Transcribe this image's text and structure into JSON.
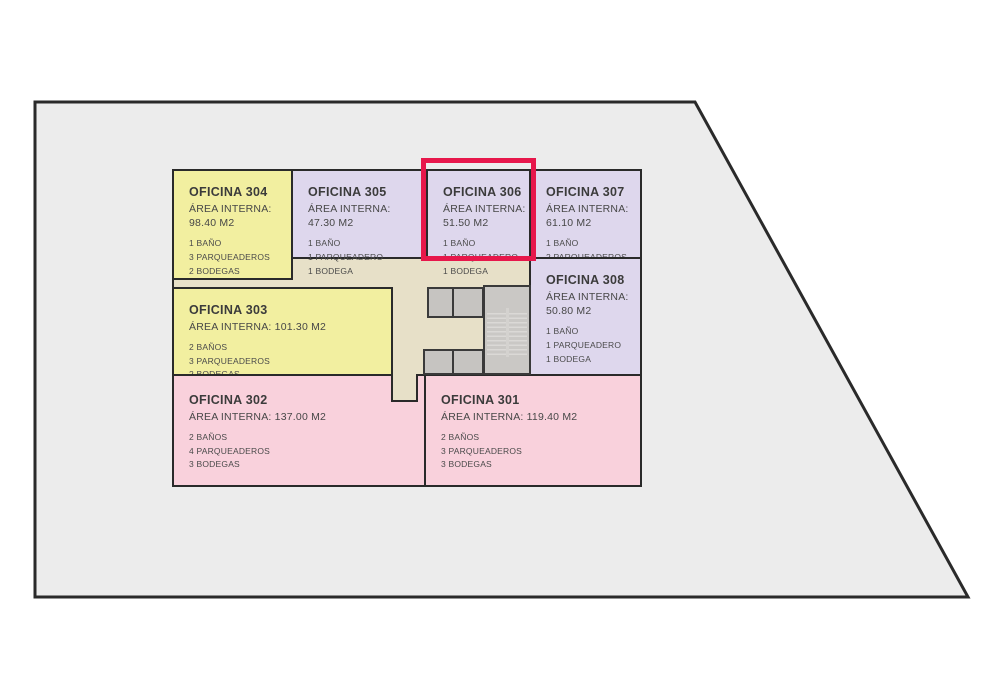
{
  "lot": {
    "fill": "#ececec",
    "outline": "#2a2a2a"
  },
  "plan": {
    "core_fill": "#e7e0c8",
    "wall_color": "#2a2a2a"
  },
  "highlight": {
    "room": "OFICINA 306",
    "color": "#e7174b"
  },
  "palette": {
    "yellow": "#f2efa0",
    "lavender": "#ded7ed",
    "pink": "#f9d1dc",
    "core_gray": "#c6c4c1"
  },
  "rooms": [
    {
      "title": "OFICINA 304",
      "area_label": "ÁREA INTERNA:",
      "area_value": "98.40 M2",
      "features": [
        "1 BAÑO",
        "3 PARQUEADEROS",
        "2 BODEGAS"
      ],
      "fill": "#f2efa0",
      "highlighted": false
    },
    {
      "title": "OFICINA 305",
      "area_label": "ÁREA INTERNA:",
      "area_value": "47.30 M2",
      "features": [
        "1 BAÑO",
        "1 PARQUEADERO",
        "1 BODEGA"
      ],
      "fill": "#ded7ed",
      "highlighted": false
    },
    {
      "title": "OFICINA 306",
      "area_label": "ÁREA INTERNA:",
      "area_value": "51.50 M2",
      "features": [
        "1 BAÑO",
        "1 PARQUEADERO",
        "1 BODEGA"
      ],
      "fill": "#ded7ed",
      "highlighted": true
    },
    {
      "title": "OFICINA 307",
      "area_label": "ÁREA INTERNA:",
      "area_value": "61.10 M2",
      "features": [
        "1 BAÑO",
        "2 PARQUEADEROS",
        "1 BODEGA"
      ],
      "fill": "#ded7ed",
      "highlighted": false
    },
    {
      "title": "OFICINA 308",
      "area_label": "ÁREA INTERNA:",
      "area_value": "50.80 M2",
      "features": [
        "1 BAÑO",
        "1 PARQUEADERO",
        "1 BODEGA"
      ],
      "fill": "#ded7ed",
      "highlighted": false
    },
    {
      "title": "OFICINA 303",
      "area_label": "ÁREA INTERNA:",
      "area_value": "101.30 M2",
      "features": [
        "2 BAÑOS",
        "3 PARQUEADEROS",
        "2 BODEGAS"
      ],
      "fill": "#f2efa0",
      "highlighted": false
    },
    {
      "title": "OFICINA 302",
      "area_label": "ÁREA INTERNA:",
      "area_value": "137.00 M2",
      "features": [
        "2 BAÑOS",
        "4 PARQUEADEROS",
        "3 BODEGAS"
      ],
      "fill": "#f9d1dc",
      "highlighted": false
    },
    {
      "title": "OFICINA 301",
      "area_label": "ÁREA INTERNA:",
      "area_value": "119.40 M2",
      "features": [
        "2 BAÑOS",
        "3 PARQUEADEROS",
        "3 BODEGAS"
      ],
      "fill": "#f9d1dc",
      "highlighted": false
    }
  ]
}
